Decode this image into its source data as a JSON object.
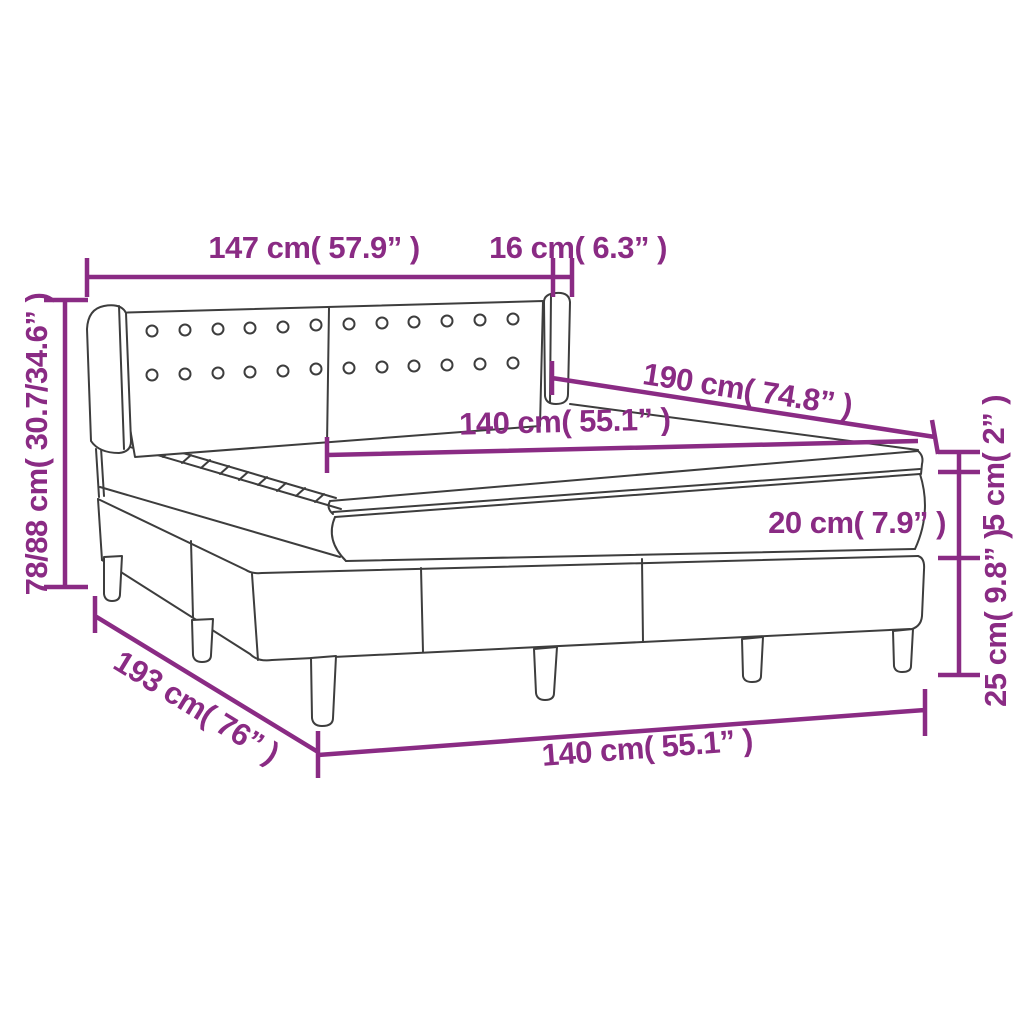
{
  "diagram": {
    "subject": "Box spring bed with headboard - dimension diagram",
    "accent_color": "#8a2b84",
    "outline_color": "#3d3d3d",
    "labels": {
      "headboard_width": "147 cm( 57.9” )",
      "wing_depth": "16 cm( 6.3” )",
      "height_range": "78/88 cm( 30.7/34.6” )",
      "mattress_length": "190 cm( 74.8” )",
      "mattress_width_top": "140 cm( 55.1” )",
      "topper_thickness": "5 cm( 2” )",
      "mattress_thickness": "20 cm( 7.9” )",
      "base_height": "25 cm( 9.8” )",
      "frame_length": "193 cm( 76” )",
      "mattress_width_bottom": "140 cm( 55.1” )"
    }
  }
}
